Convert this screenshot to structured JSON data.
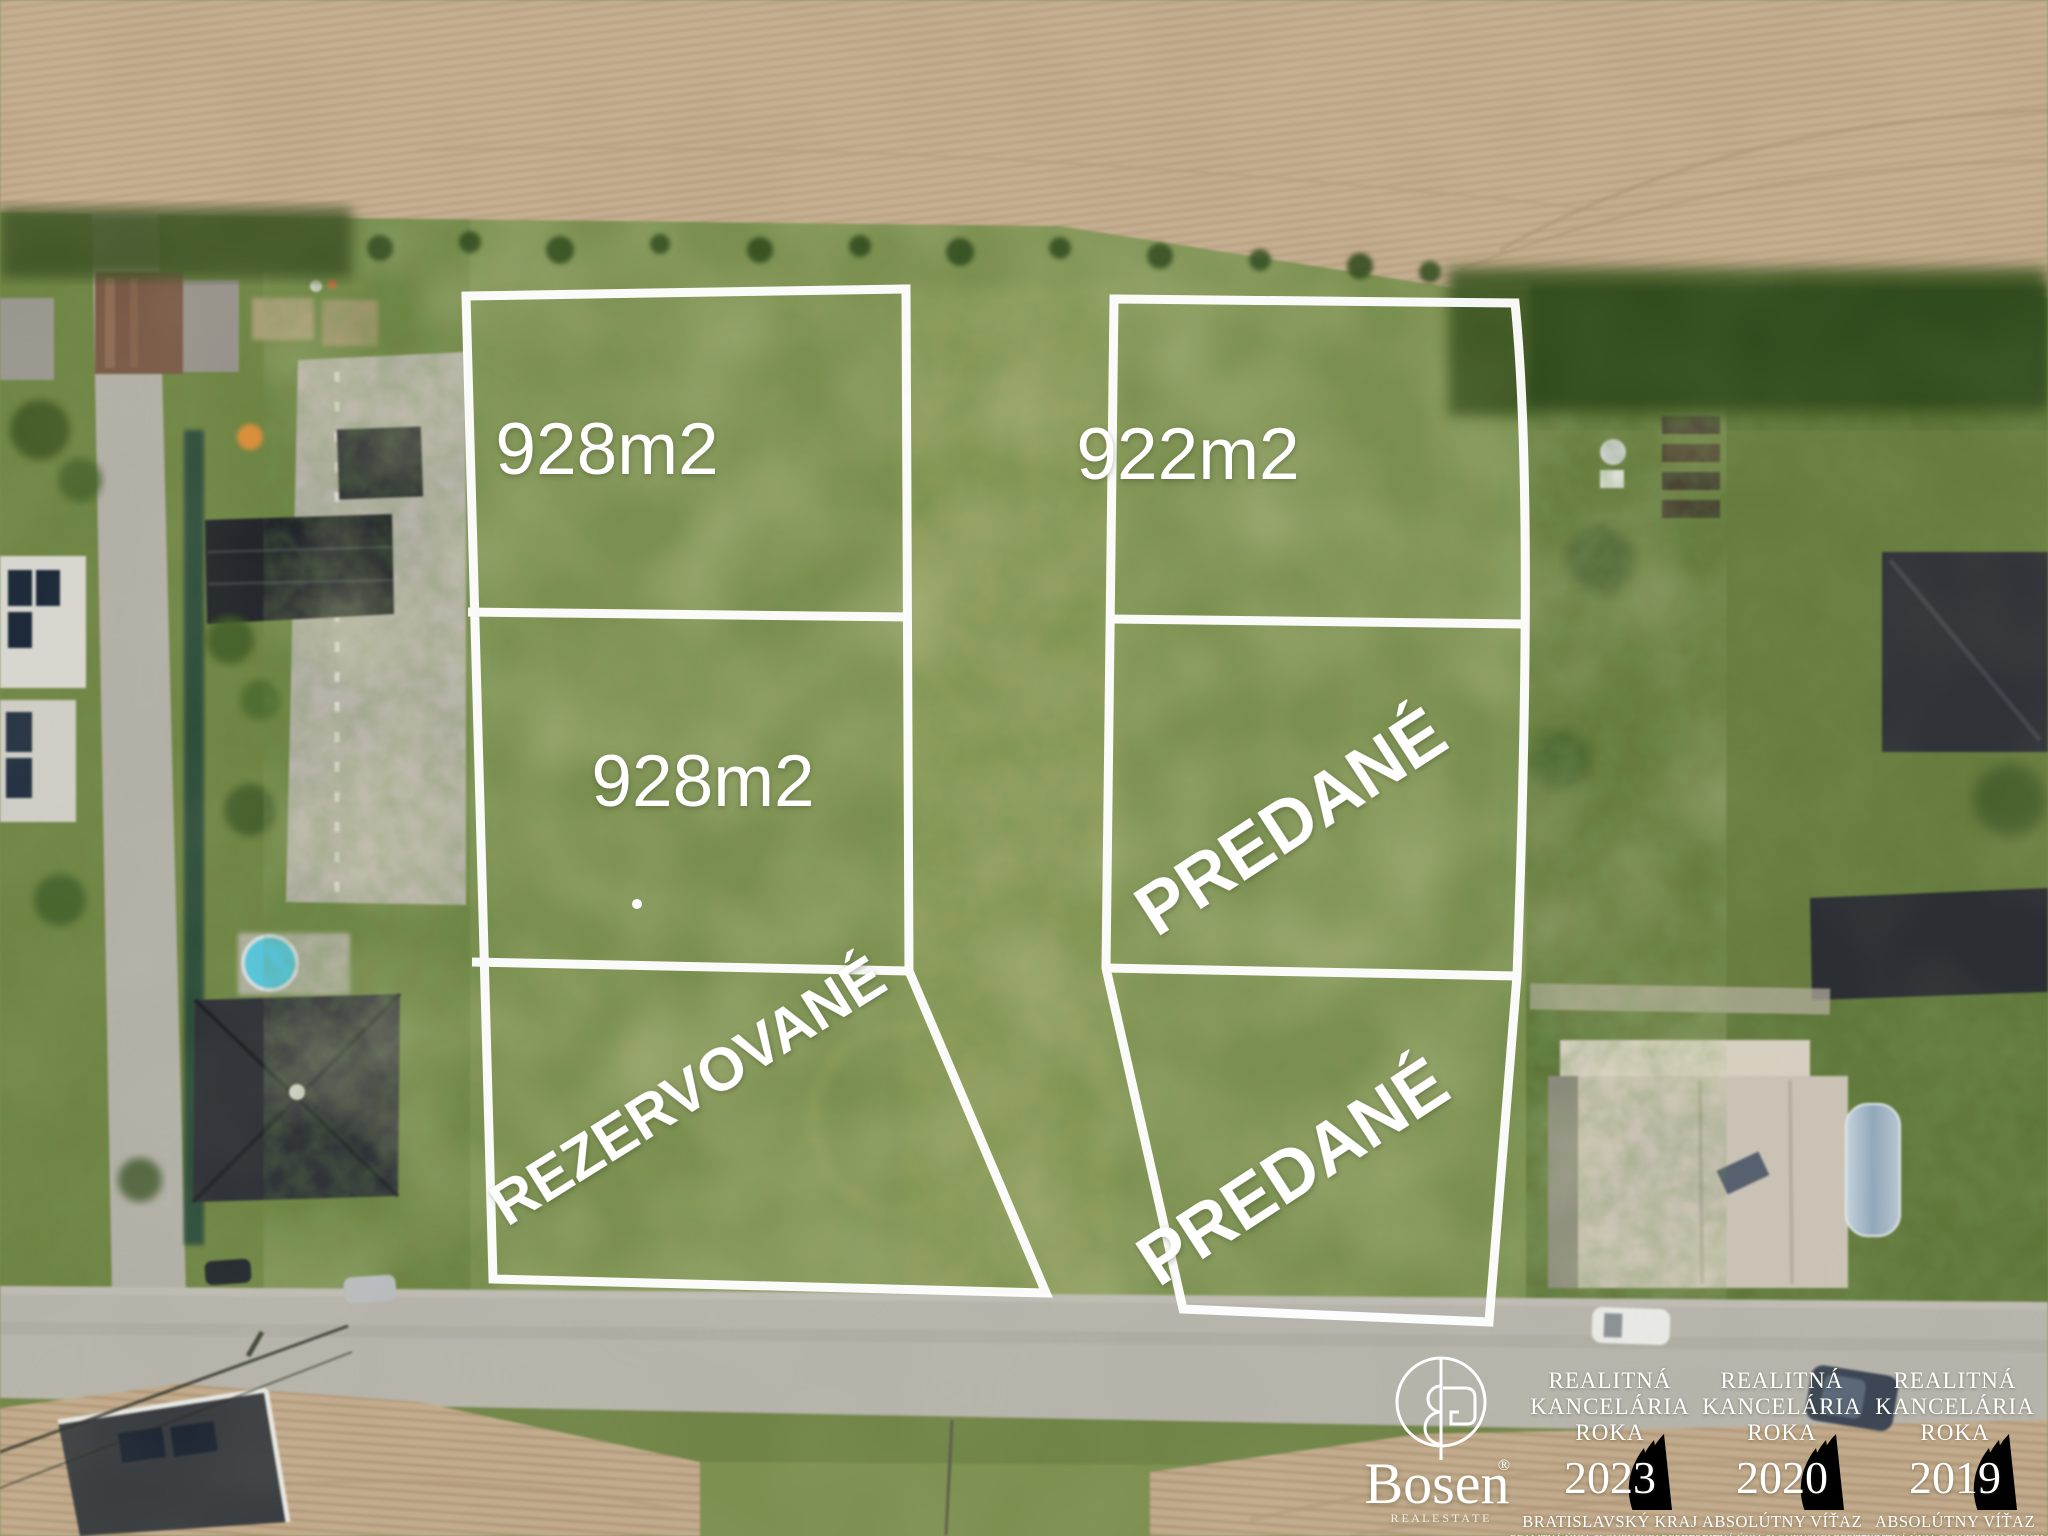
{
  "scene": {
    "description_labels": {
      "plot_line_color": "#ffffff"
    }
  },
  "palette": {
    "overlay_white": "#ffffff",
    "meadow_green": "#7d9050",
    "garden_green_dark": "#5e7538",
    "field_tan": "#c4ad90",
    "field_row_shadow": "#b29a7c",
    "road_gray": "#b6b3ab",
    "roof_charcoal": "#2e3134",
    "barn_brown": "#7a5a47",
    "pool_blue": "#57c4da",
    "hedge_dark_green": "#2f4a1c"
  },
  "plots": [
    {
      "id": "plot-top-left",
      "label": "928m2"
    },
    {
      "id": "plot-middle-left",
      "label": "928m2"
    },
    {
      "id": "plot-bottom-left",
      "label": "REZERVOVANÉ"
    },
    {
      "id": "plot-top-right",
      "label": "922m2"
    },
    {
      "id": "plot-middle-right",
      "label": "PREDANÉ"
    },
    {
      "id": "plot-bottom-right",
      "label": "PREDANÉ"
    }
  ],
  "logo": {
    "name": "Bosen",
    "registered": "®",
    "tagline": "R E A L   E S T A T E"
  },
  "badges": [
    {
      "line1": "REALITNÁ",
      "line2": "KANCELÁRIA",
      "line3": "ROKA",
      "year": "2023",
      "subtitle": "BRATISLAVSKÝ KRAJ",
      "fineprint": "REALITNÁ ÚNIA SLOVENSKEJ REPUBLIKY"
    },
    {
      "line1": "REALITNÁ",
      "line2": "KANCELÁRIA",
      "line3": "ROKA",
      "year": "2020",
      "subtitle": "ABSOLÚTNY VÍŤAZ",
      "fineprint": "REALITNÁ ÚNIA SLOVENSKEJ REPUBLIKY"
    },
    {
      "line1": "REALITNÁ",
      "line2": "KANCELÁRIA",
      "line3": "ROKA",
      "year": "2019",
      "subtitle": "ABSOLÚTNY VÍŤAZ",
      "fineprint": "REALITNÁ ÚNIA SLOVENSKEJ REPUBLIKY"
    }
  ]
}
